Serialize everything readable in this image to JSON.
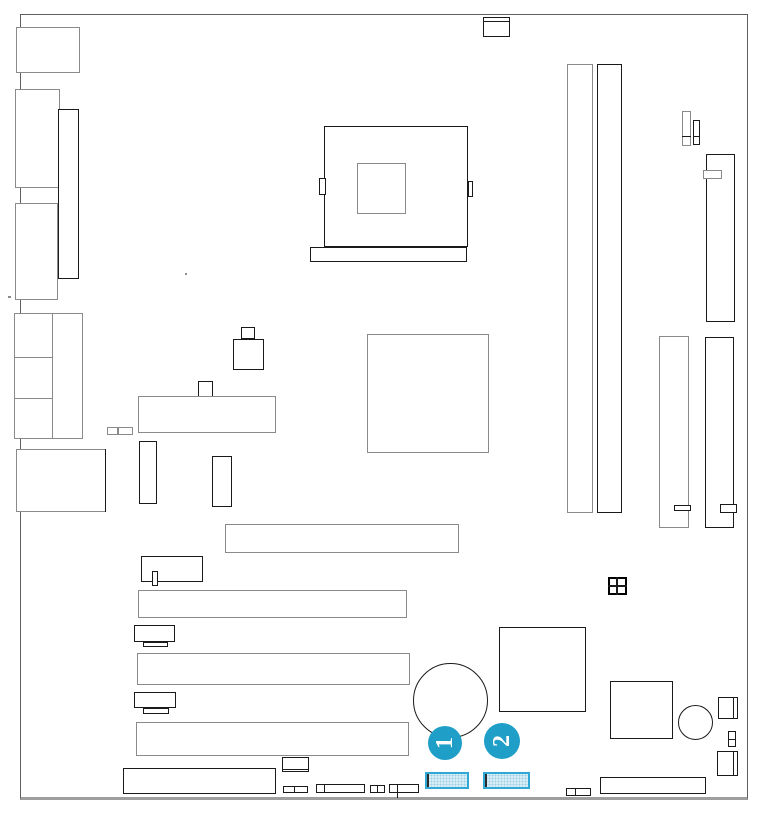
{
  "diagram": {
    "name": "motherboard-layout-diagram",
    "colors": {
      "background": "#ffffff",
      "line_black": "#1a1a1a",
      "line_gray": "#8a8a8a",
      "accent": "#1f9fc8",
      "highlight_border": "#2fa8d5",
      "highlight_fill": "#d9edf6"
    },
    "components": [
      {
        "name": "board-outline",
        "type": "board",
        "x": 20,
        "y": 14,
        "w": 728,
        "h": 786
      },
      {
        "name": "io-port-keyboard",
        "type": "rect",
        "x": 16,
        "y": 27,
        "w": 64,
        "h": 46,
        "stroke": "gray"
      },
      {
        "name": "io-port-com",
        "type": "rect",
        "x": 15,
        "y": 89,
        "w": 45,
        "h": 99,
        "stroke": "gray"
      },
      {
        "name": "io-port-parallel",
        "type": "rect",
        "x": 58,
        "y": 109,
        "w": 21,
        "h": 170,
        "stroke": "black"
      },
      {
        "name": "io-port-vga",
        "type": "rect",
        "x": 15,
        "y": 203,
        "w": 43,
        "h": 97,
        "stroke": "gray"
      },
      {
        "name": "io-audio-block",
        "type": "rect",
        "x": 14,
        "y": 313,
        "w": 69,
        "h": 126,
        "stroke": "gray"
      },
      {
        "name": "io-audio-divider",
        "type": "vline",
        "x": 52,
        "y": 313,
        "len": 126,
        "stroke": "gray"
      },
      {
        "name": "io-audio-line-1",
        "type": "hline",
        "x": 14,
        "y": 357,
        "len": 38,
        "stroke": "gray"
      },
      {
        "name": "io-audio-line-2",
        "type": "hline",
        "x": 14,
        "y": 398,
        "len": 38,
        "stroke": "gray"
      },
      {
        "name": "io-port-lan",
        "type": "rect",
        "x": 16,
        "y": 449,
        "w": 90,
        "h": 63,
        "stroke": "gray"
      },
      {
        "name": "io-port-lan-edge",
        "type": "vline",
        "x": 105,
        "y": 449,
        "len": 63,
        "stroke": "black"
      },
      {
        "name": "fan-header-top",
        "type": "rect",
        "x": 483,
        "y": 17,
        "w": 27,
        "h": 20,
        "stroke": "black"
      },
      {
        "name": "fan-header-top-line",
        "type": "hline",
        "x": 483,
        "y": 21,
        "len": 27,
        "stroke": "black"
      },
      {
        "name": "cpu-socket",
        "type": "rect",
        "x": 324,
        "y": 126,
        "w": 144,
        "h": 121,
        "stroke": "black"
      },
      {
        "name": "cpu-core",
        "type": "rect",
        "x": 357,
        "y": 163,
        "w": 49,
        "h": 51,
        "stroke": "gray"
      },
      {
        "name": "cpu-lever-left",
        "type": "rect",
        "x": 319,
        "y": 178,
        "w": 7,
        "h": 17,
        "stroke": "black"
      },
      {
        "name": "cpu-lever-right",
        "type": "rect",
        "x": 468,
        "y": 181,
        "w": 5,
        "h": 16,
        "stroke": "black"
      },
      {
        "name": "cpu-retention-bar",
        "type": "rect",
        "x": 310,
        "y": 247,
        "w": 157,
        "h": 15,
        "stroke": "black"
      },
      {
        "name": "northbridge-chip",
        "type": "rect",
        "x": 367,
        "y": 334,
        "w": 122,
        "h": 119,
        "stroke": "gray"
      },
      {
        "name": "component-cap-small",
        "type": "rect",
        "x": 241,
        "y": 327,
        "w": 14,
        "h": 12,
        "stroke": "black"
      },
      {
        "name": "component-block",
        "type": "rect",
        "x": 233,
        "y": 339,
        "w": 31,
        "h": 31,
        "stroke": "black"
      },
      {
        "name": "component-square",
        "type": "rect",
        "x": 198,
        "y": 381,
        "w": 15,
        "h": 17,
        "stroke": "black"
      },
      {
        "name": "atx-power-connector",
        "type": "rect",
        "x": 138,
        "y": 396,
        "w": 138,
        "h": 37,
        "stroke": "gray"
      },
      {
        "name": "fuse-a",
        "type": "rect",
        "x": 107,
        "y": 427,
        "w": 11,
        "h": 8,
        "stroke": "gray"
      },
      {
        "name": "fuse-b",
        "type": "rect",
        "x": 118,
        "y": 427,
        "w": 15,
        "h": 8,
        "stroke": "gray"
      },
      {
        "name": "vrm-a",
        "type": "rect",
        "x": 139,
        "y": 441,
        "w": 18,
        "h": 63,
        "stroke": "black"
      },
      {
        "name": "vrm-b",
        "type": "rect",
        "x": 212,
        "y": 456,
        "w": 20,
        "h": 51,
        "stroke": "black"
      },
      {
        "name": "dimm-slot-1",
        "type": "rect",
        "x": 567,
        "y": 64,
        "w": 26,
        "h": 449,
        "stroke": "gray"
      },
      {
        "name": "dimm-slot-2",
        "type": "rect",
        "x": 597,
        "y": 64,
        "w": 25,
        "h": 449,
        "stroke": "black"
      },
      {
        "name": "header-small-a",
        "type": "rect",
        "x": 682,
        "y": 111,
        "w": 9,
        "h": 35,
        "stroke": "gray"
      },
      {
        "name": "header-small-a-div",
        "type": "hline",
        "x": 682,
        "y": 136,
        "len": 9,
        "stroke": "black"
      },
      {
        "name": "header-small-b",
        "type": "rect",
        "x": 693,
        "y": 120,
        "w": 7,
        "h": 25,
        "stroke": "black"
      },
      {
        "name": "header-small-b-div",
        "type": "hline",
        "x": 693,
        "y": 136,
        "len": 7,
        "stroke": "black"
      },
      {
        "name": "ide-connector-1",
        "type": "rect",
        "x": 706,
        "y": 154,
        "w": 29,
        "h": 168,
        "stroke": "black"
      },
      {
        "name": "ide-connector-1-key",
        "type": "rect",
        "x": 703,
        "y": 170,
        "w": 19,
        "h": 9,
        "stroke": "gray"
      },
      {
        "name": "ide-connector-2",
        "type": "rect",
        "x": 659,
        "y": 336,
        "w": 30,
        "h": 192,
        "stroke": "gray"
      },
      {
        "name": "ide-connector-2-key",
        "type": "rect",
        "x": 674,
        "y": 505,
        "w": 17,
        "h": 6,
        "stroke": "black"
      },
      {
        "name": "ide-connector-3",
        "type": "rect",
        "x": 705,
        "y": 337,
        "w": 29,
        "h": 191,
        "stroke": "black"
      },
      {
        "name": "ide-connector-3-key",
        "type": "rect",
        "x": 720,
        "y": 504,
        "w": 17,
        "h": 9,
        "stroke": "black"
      },
      {
        "name": "agp-slot",
        "type": "rect",
        "x": 225,
        "y": 524,
        "w": 234,
        "h": 29,
        "stroke": "gray"
      },
      {
        "name": "header-bracket-a",
        "type": "rect",
        "x": 141,
        "y": 556,
        "w": 62,
        "h": 26,
        "stroke": "black"
      },
      {
        "name": "header-bracket-a-key",
        "type": "rect",
        "x": 152,
        "y": 571,
        "w": 6,
        "h": 15,
        "stroke": "black"
      },
      {
        "name": "pci-slot-1",
        "type": "rect",
        "x": 138,
        "y": 590,
        "w": 269,
        "h": 28,
        "stroke": "gray"
      },
      {
        "name": "header-bracket-b",
        "type": "rect",
        "x": 134,
        "y": 625,
        "w": 41,
        "h": 17,
        "stroke": "black"
      },
      {
        "name": "header-bracket-b-key",
        "type": "rect",
        "x": 143,
        "y": 642,
        "w": 25,
        "h": 5,
        "stroke": "black"
      },
      {
        "name": "pci-slot-2",
        "type": "rect",
        "x": 137,
        "y": 653,
        "w": 273,
        "h": 32,
        "stroke": "gray"
      },
      {
        "name": "header-bracket-c",
        "type": "rect",
        "x": 134,
        "y": 692,
        "w": 42,
        "h": 16,
        "stroke": "black"
      },
      {
        "name": "header-bracket-c-key",
        "type": "rect",
        "x": 143,
        "y": 708,
        "w": 26,
        "h": 6,
        "stroke": "black"
      },
      {
        "name": "pci-slot-3",
        "type": "rect",
        "x": 136,
        "y": 722,
        "w": 273,
        "h": 34,
        "stroke": "gray"
      },
      {
        "name": "jumper-block",
        "type": "rect2",
        "x": 608,
        "y": 577,
        "w": 19,
        "h": 18
      },
      {
        "name": "jumper-block-vdiv",
        "type": "vline2",
        "x": 616,
        "y": 577,
        "len": 18
      },
      {
        "name": "jumper-block-hdiv",
        "type": "hline2",
        "x": 608,
        "y": 585,
        "len": 19
      },
      {
        "name": "southbridge-chip",
        "type": "rect",
        "x": 499,
        "y": 627,
        "w": 87,
        "h": 85,
        "stroke": "black"
      },
      {
        "name": "battery",
        "type": "circle",
        "x": 413,
        "y": 663,
        "w": 75,
        "h": 75,
        "stroke": "black"
      },
      {
        "name": "bios-chip",
        "type": "rect",
        "x": 610,
        "y": 681,
        "w": 63,
        "h": 58,
        "stroke": "black"
      },
      {
        "name": "buzzer",
        "type": "circle",
        "x": 678,
        "y": 705,
        "w": 35,
        "h": 35,
        "stroke": "black"
      },
      {
        "name": "connector-right-1",
        "type": "rect",
        "x": 718,
        "y": 697,
        "w": 20,
        "h": 22,
        "stroke": "black"
      },
      {
        "name": "connector-right-1-div",
        "type": "vline",
        "x": 733,
        "y": 697,
        "len": 22,
        "stroke": "black"
      },
      {
        "name": "connector-right-2",
        "type": "rect",
        "x": 728,
        "y": 731,
        "w": 8,
        "h": 16,
        "stroke": "black"
      },
      {
        "name": "connector-right-2-div",
        "type": "hline",
        "x": 728,
        "y": 739,
        "len": 8,
        "stroke": "black"
      },
      {
        "name": "connector-right-3",
        "type": "rect",
        "x": 717,
        "y": 751,
        "w": 21,
        "h": 25,
        "stroke": "black"
      },
      {
        "name": "connector-right-3-div",
        "type": "vline",
        "x": 733,
        "y": 751,
        "len": 25,
        "stroke": "black"
      },
      {
        "name": "header-bottom-right",
        "type": "rect",
        "x": 600,
        "y": 777,
        "w": 106,
        "h": 17,
        "stroke": "black"
      },
      {
        "name": "connector-bottom-right-small",
        "type": "rect",
        "x": 566,
        "y": 788,
        "w": 25,
        "h": 8,
        "stroke": "black"
      },
      {
        "name": "connector-bottom-right-small-div",
        "type": "vline",
        "x": 575,
        "y": 788,
        "len": 8,
        "stroke": "black"
      },
      {
        "name": "front-panel-header",
        "type": "rect",
        "x": 123,
        "y": 768,
        "w": 153,
        "h": 26,
        "stroke": "black"
      },
      {
        "name": "header-below-pci3",
        "type": "rect",
        "x": 282,
        "y": 757,
        "w": 27,
        "h": 15,
        "stroke": "black"
      },
      {
        "name": "header-below-pci3-div",
        "type": "hline",
        "x": 282,
        "y": 769,
        "len": 27,
        "stroke": "black"
      },
      {
        "name": "bottom-header-1",
        "type": "rect",
        "x": 283,
        "y": 786,
        "w": 25,
        "h": 7,
        "stroke": "black"
      },
      {
        "name": "bottom-header-1-div",
        "type": "vline",
        "x": 294,
        "y": 786,
        "len": 7,
        "stroke": "black"
      },
      {
        "name": "bottom-header-2",
        "type": "rect",
        "x": 316,
        "y": 784,
        "w": 49,
        "h": 9,
        "stroke": "black"
      },
      {
        "name": "bottom-header-2-div",
        "type": "vline",
        "x": 324,
        "y": 784,
        "len": 9,
        "stroke": "black"
      },
      {
        "name": "bottom-header-3",
        "type": "rect",
        "x": 370,
        "y": 785,
        "w": 15,
        "h": 8,
        "stroke": "black"
      },
      {
        "name": "bottom-header-3-div",
        "type": "vline",
        "x": 377,
        "y": 785,
        "len": 8,
        "stroke": "black"
      },
      {
        "name": "bottom-header-4",
        "type": "rect",
        "x": 389,
        "y": 784,
        "w": 30,
        "h": 9,
        "stroke": "black"
      },
      {
        "name": "bottom-header-4-div",
        "type": "vline",
        "x": 397,
        "y": 784,
        "len": 14,
        "stroke": "black"
      },
      {
        "name": "stray-mark-a",
        "type": "dot",
        "x": 185,
        "y": 273,
        "w": 2,
        "h": 2
      },
      {
        "name": "stray-mark-b",
        "type": "dot",
        "x": 8,
        "y": 296,
        "w": 3,
        "h": 2
      }
    ],
    "highlighted_connectors": [
      {
        "name": "highlighted-connector-1",
        "x": 425,
        "y": 772,
        "w": 44,
        "h": 17
      },
      {
        "name": "highlighted-connector-2",
        "x": 483,
        "y": 772,
        "w": 47,
        "h": 17
      }
    ],
    "callouts": [
      {
        "label": "1",
        "cx": 445,
        "cy": 743,
        "r": 17
      },
      {
        "label": "2",
        "cx": 502,
        "cy": 741,
        "r": 18
      }
    ]
  }
}
